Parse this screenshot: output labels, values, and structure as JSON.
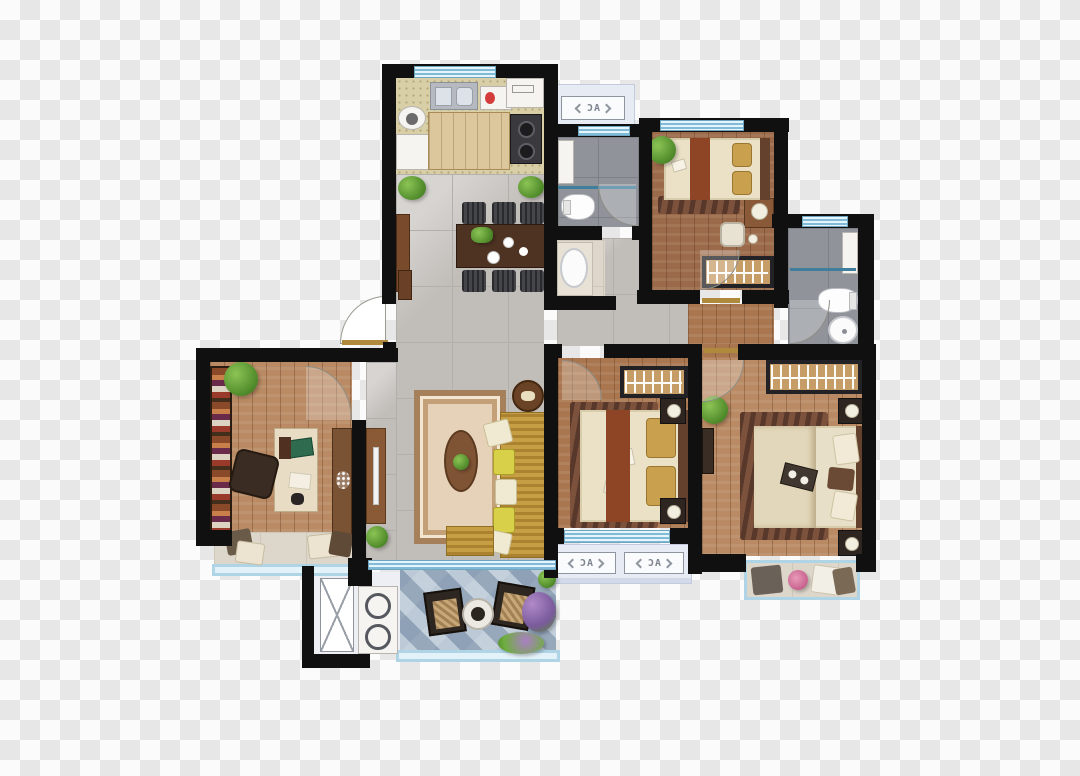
{
  "labels": {
    "ac": "AC"
  },
  "palette": {
    "wall": "#101010",
    "tile_floor": "#c1bdb9",
    "wood_floor": "#a9764f",
    "kitchen_floor": "#d9cfa6",
    "bath_tile": "#90949a",
    "balcony_stone": "#9fb2c4",
    "window_blue": "#7fbad6",
    "ac_platform": "#e7ebf4",
    "sofa_yellow": "#c69f45",
    "carpet_beige": "#e6d2b8",
    "bed_linen": "#eae1c6",
    "bed_runner_red": "#8e4526",
    "checker_light": "#fbfbfb",
    "checker_dark": "#e7e7e7"
  }
}
